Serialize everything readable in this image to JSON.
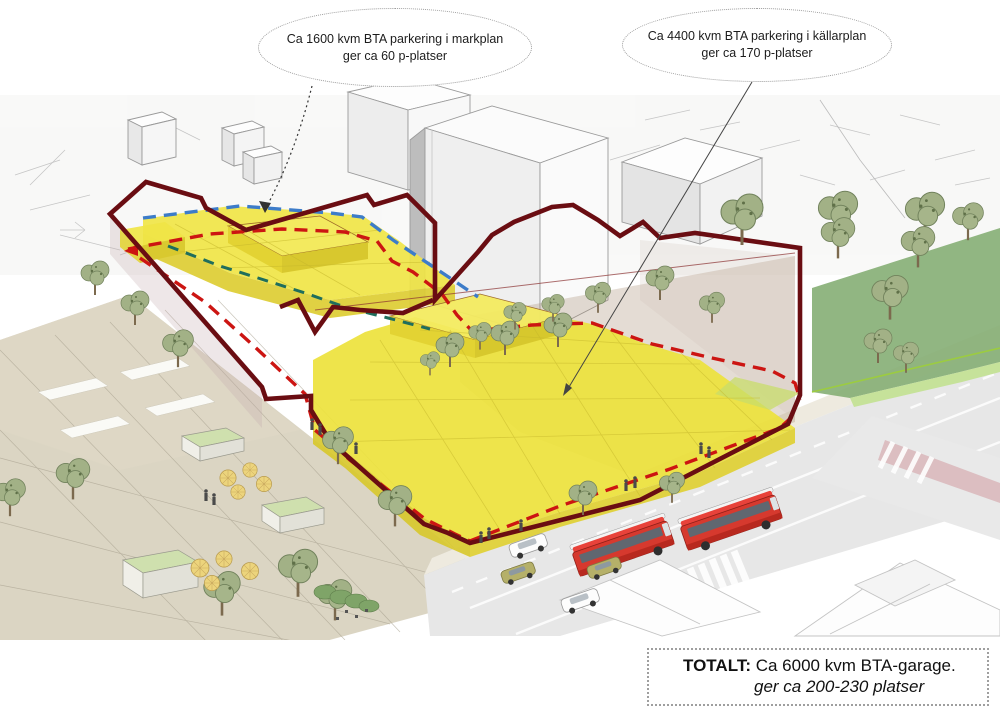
{
  "callouts": [
    {
      "text_line1": "Ca 1600 kvm BTA parkering i markplan",
      "text_line2": "ger ca 60 p-platser"
    },
    {
      "text_line1": "Ca 4400 kvm BTA parkering i källarplan",
      "text_line2": "ger ca 170 p-platser"
    }
  ],
  "total_box": {
    "label": "TOTALT:",
    "line1": "Ca 6000 kvm BTA-garage.",
    "line2": "ger ca 200-230 platser"
  },
  "colors": {
    "site_boundary_maroon": "#6a0d12",
    "parking_yellow": "#f0e547",
    "dash_red": "#cc1512",
    "dash_blue": "#3d7cc9",
    "dash_green": "#1f6e5c",
    "bus_red": "#d6392e",
    "lawn_green": "#85ae74",
    "plaza_beige": "#d8d1be"
  }
}
